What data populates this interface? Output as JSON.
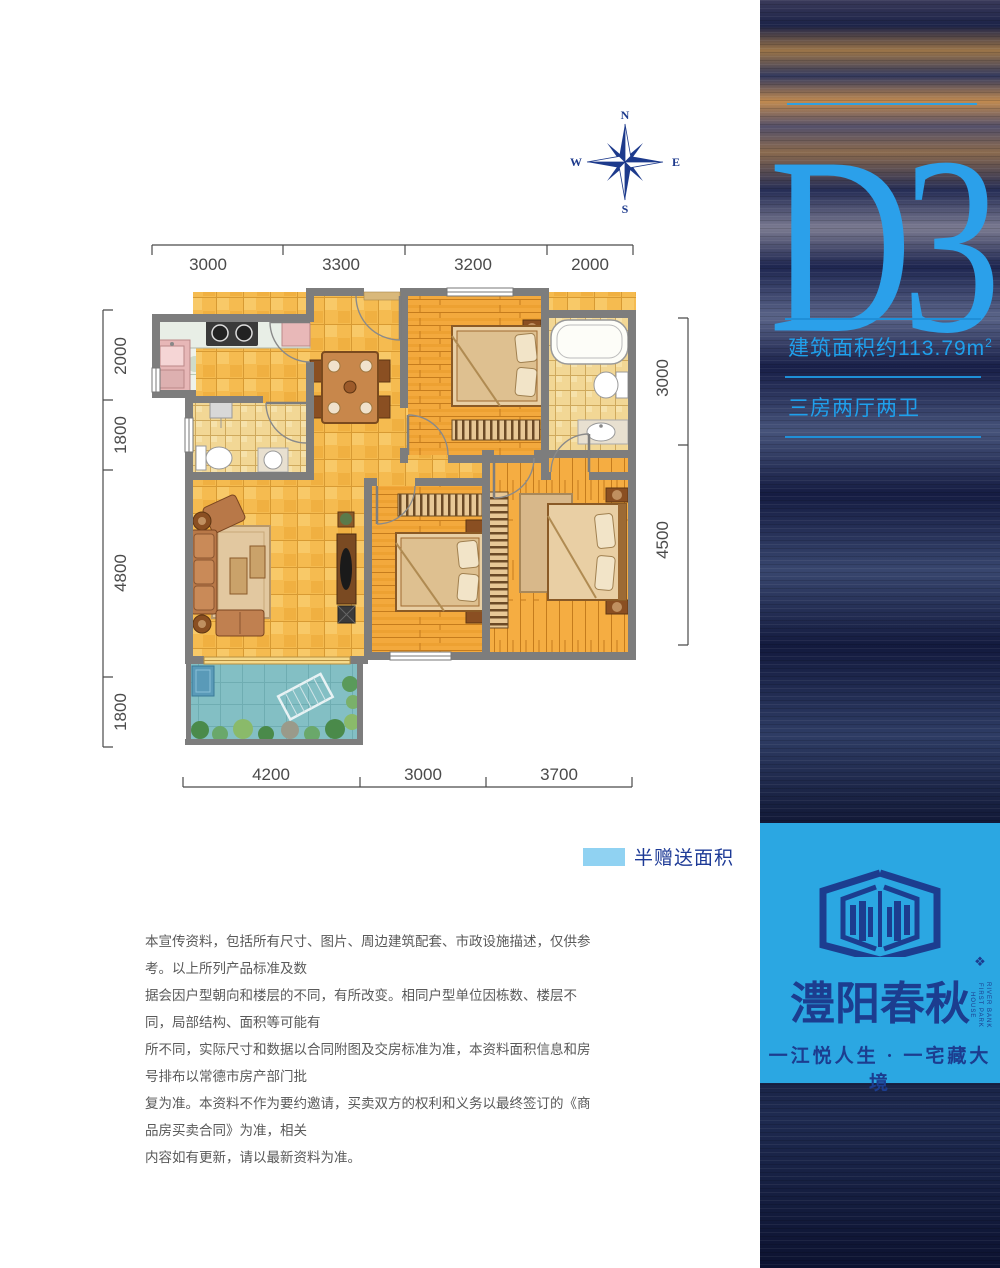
{
  "unit": {
    "code": "D3",
    "area_text": "建筑面积约113.79m",
    "area_sup": "2",
    "rooms_text": "三房两厅两卫"
  },
  "legend": {
    "label": "半赠送面积",
    "swatch_color": "#90D2F2"
  },
  "compass": {
    "north": "N",
    "south": "S",
    "east": "E",
    "west": "W"
  },
  "dimensions": {
    "top": [
      "3000",
      "3300",
      "3200",
      "2000"
    ],
    "left": [
      "2000",
      "1800",
      "4800",
      "1800"
    ],
    "right": [
      "3000",
      "4500"
    ],
    "bottom": [
      "4200",
      "3000",
      "3700"
    ]
  },
  "disclaimer": {
    "lines": [
      "本宣传资料，包括所有尺寸、图片、周边建筑配套、市政设施描述，仅供参考。以上所列产品标准及数",
      "据会因户型朝向和楼层的不同，有所改变。相同户型单位因栋数、楼层不同，局部结构、面积等可能有",
      "所不同，实际尺寸和数据以合同附图及交房标准为准，本资料面积信息和房号排布以常德市房产部门批",
      "复为准。本资料不作为要约邀请，买卖双方的权利和义务以最终签订的《商品房买卖合同》为准，相关",
      "内容如有更新，请以最新资料为准。"
    ]
  },
  "brand": {
    "name": "澧阳春秋",
    "tagline": "一江悦人生 · 一宅藏大境",
    "english_vertical": [
      "RIVER BANK",
      "FIRST PARK HOUSE"
    ]
  },
  "colors": {
    "accent_blue": "#1FA0EC",
    "title_blue": "#2BA0EA",
    "navy": "#1C3D8F",
    "logo_block_bg": "#2BA7E2",
    "legend_swatch": "#90D2F2",
    "wall_gray": "#7D7D7D",
    "floor_tile_orange": "#F5BB50",
    "wood_orange": "#F3A93D",
    "balcony_teal": "#83BFC4",
    "dimension_text": "#4A4A4A"
  }
}
